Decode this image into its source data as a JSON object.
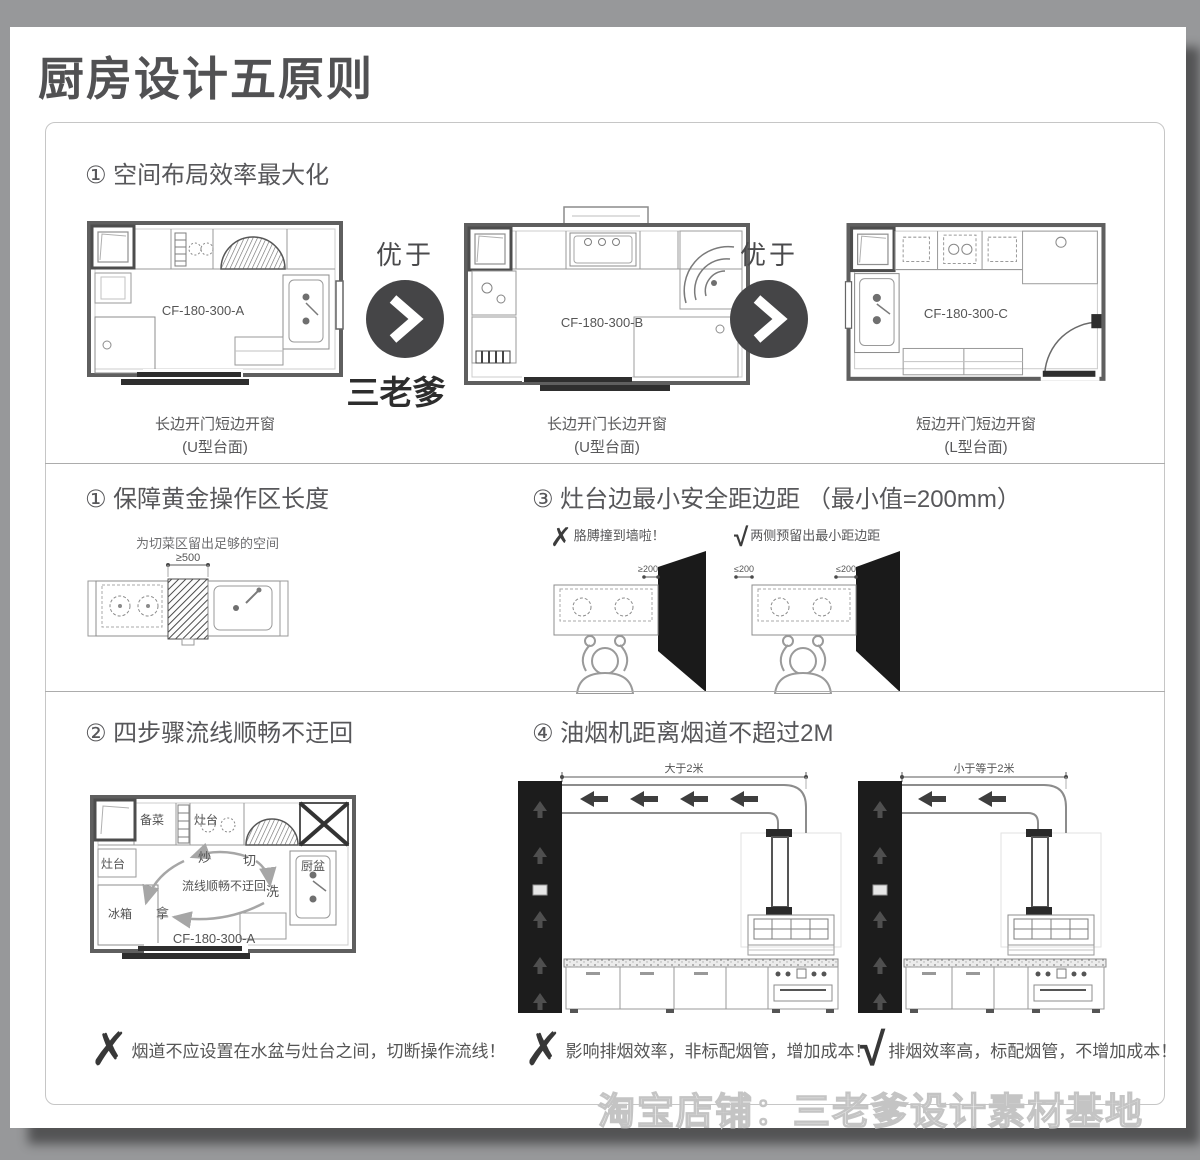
{
  "page": {
    "title": "厨房设计五原则",
    "watermark_arrow": "三老爹",
    "watermark_bottom": "淘宝店铺：三老爹设计素材基地"
  },
  "section1": {
    "header": "① 空间布局效率最大化",
    "better_label": "优于",
    "plans": [
      {
        "code": "CF-180-300-A",
        "caption_line1": "长边开门短边开窗",
        "caption_line2": "(U型台面)"
      },
      {
        "code": "CF-180-300-B",
        "caption_line1": "长边开门长边开窗",
        "caption_line2": "(U型台面)"
      },
      {
        "code": "CF-180-300-C",
        "caption_line1": "短边开门短边开窗",
        "caption_line2": "(L型台面)"
      }
    ]
  },
  "section2": {
    "header": "① 保障黄金操作区长度",
    "note": "为切菜区留出足够的空间",
    "dimension": "≥500"
  },
  "section3": {
    "header": "③ 灶台边最小安全距边距 （最小值=200mm）",
    "bad": {
      "mark": "✗",
      "label": "胳膊撞到墙啦！",
      "dimension": "≥200"
    },
    "good": {
      "mark": "√",
      "label": "两侧预留出最小距边距",
      "dimension_left": "≤200",
      "dimension_right": "≤200"
    }
  },
  "section4": {
    "header": "② 四步骤流线顺畅不迂回",
    "plan_code": "CF-180-300-A",
    "labels": {
      "prep": "备菜",
      "stove_top": "灶台",
      "stove_left": "灶台",
      "fry": "炒",
      "cut": "切",
      "wash": "洗",
      "take": "拿",
      "fridge": "冰箱",
      "sink": "厨盆",
      "flow": "流线顺畅不迂回"
    },
    "note_mark": "✗",
    "note": "烟道不应设置在水盆与灶台之间，切断操作流线！"
  },
  "section5": {
    "header": "④ 油烟机距离烟道不超过2M",
    "bad": {
      "dimension": "大于2米",
      "mark": "✗",
      "note": "影响排烟效率，非标配烟管，增加成本！"
    },
    "good": {
      "dimension": "小于等于2米",
      "mark": "√",
      "note": "排烟效率高，标配烟管，不增加成本！"
    }
  }
}
